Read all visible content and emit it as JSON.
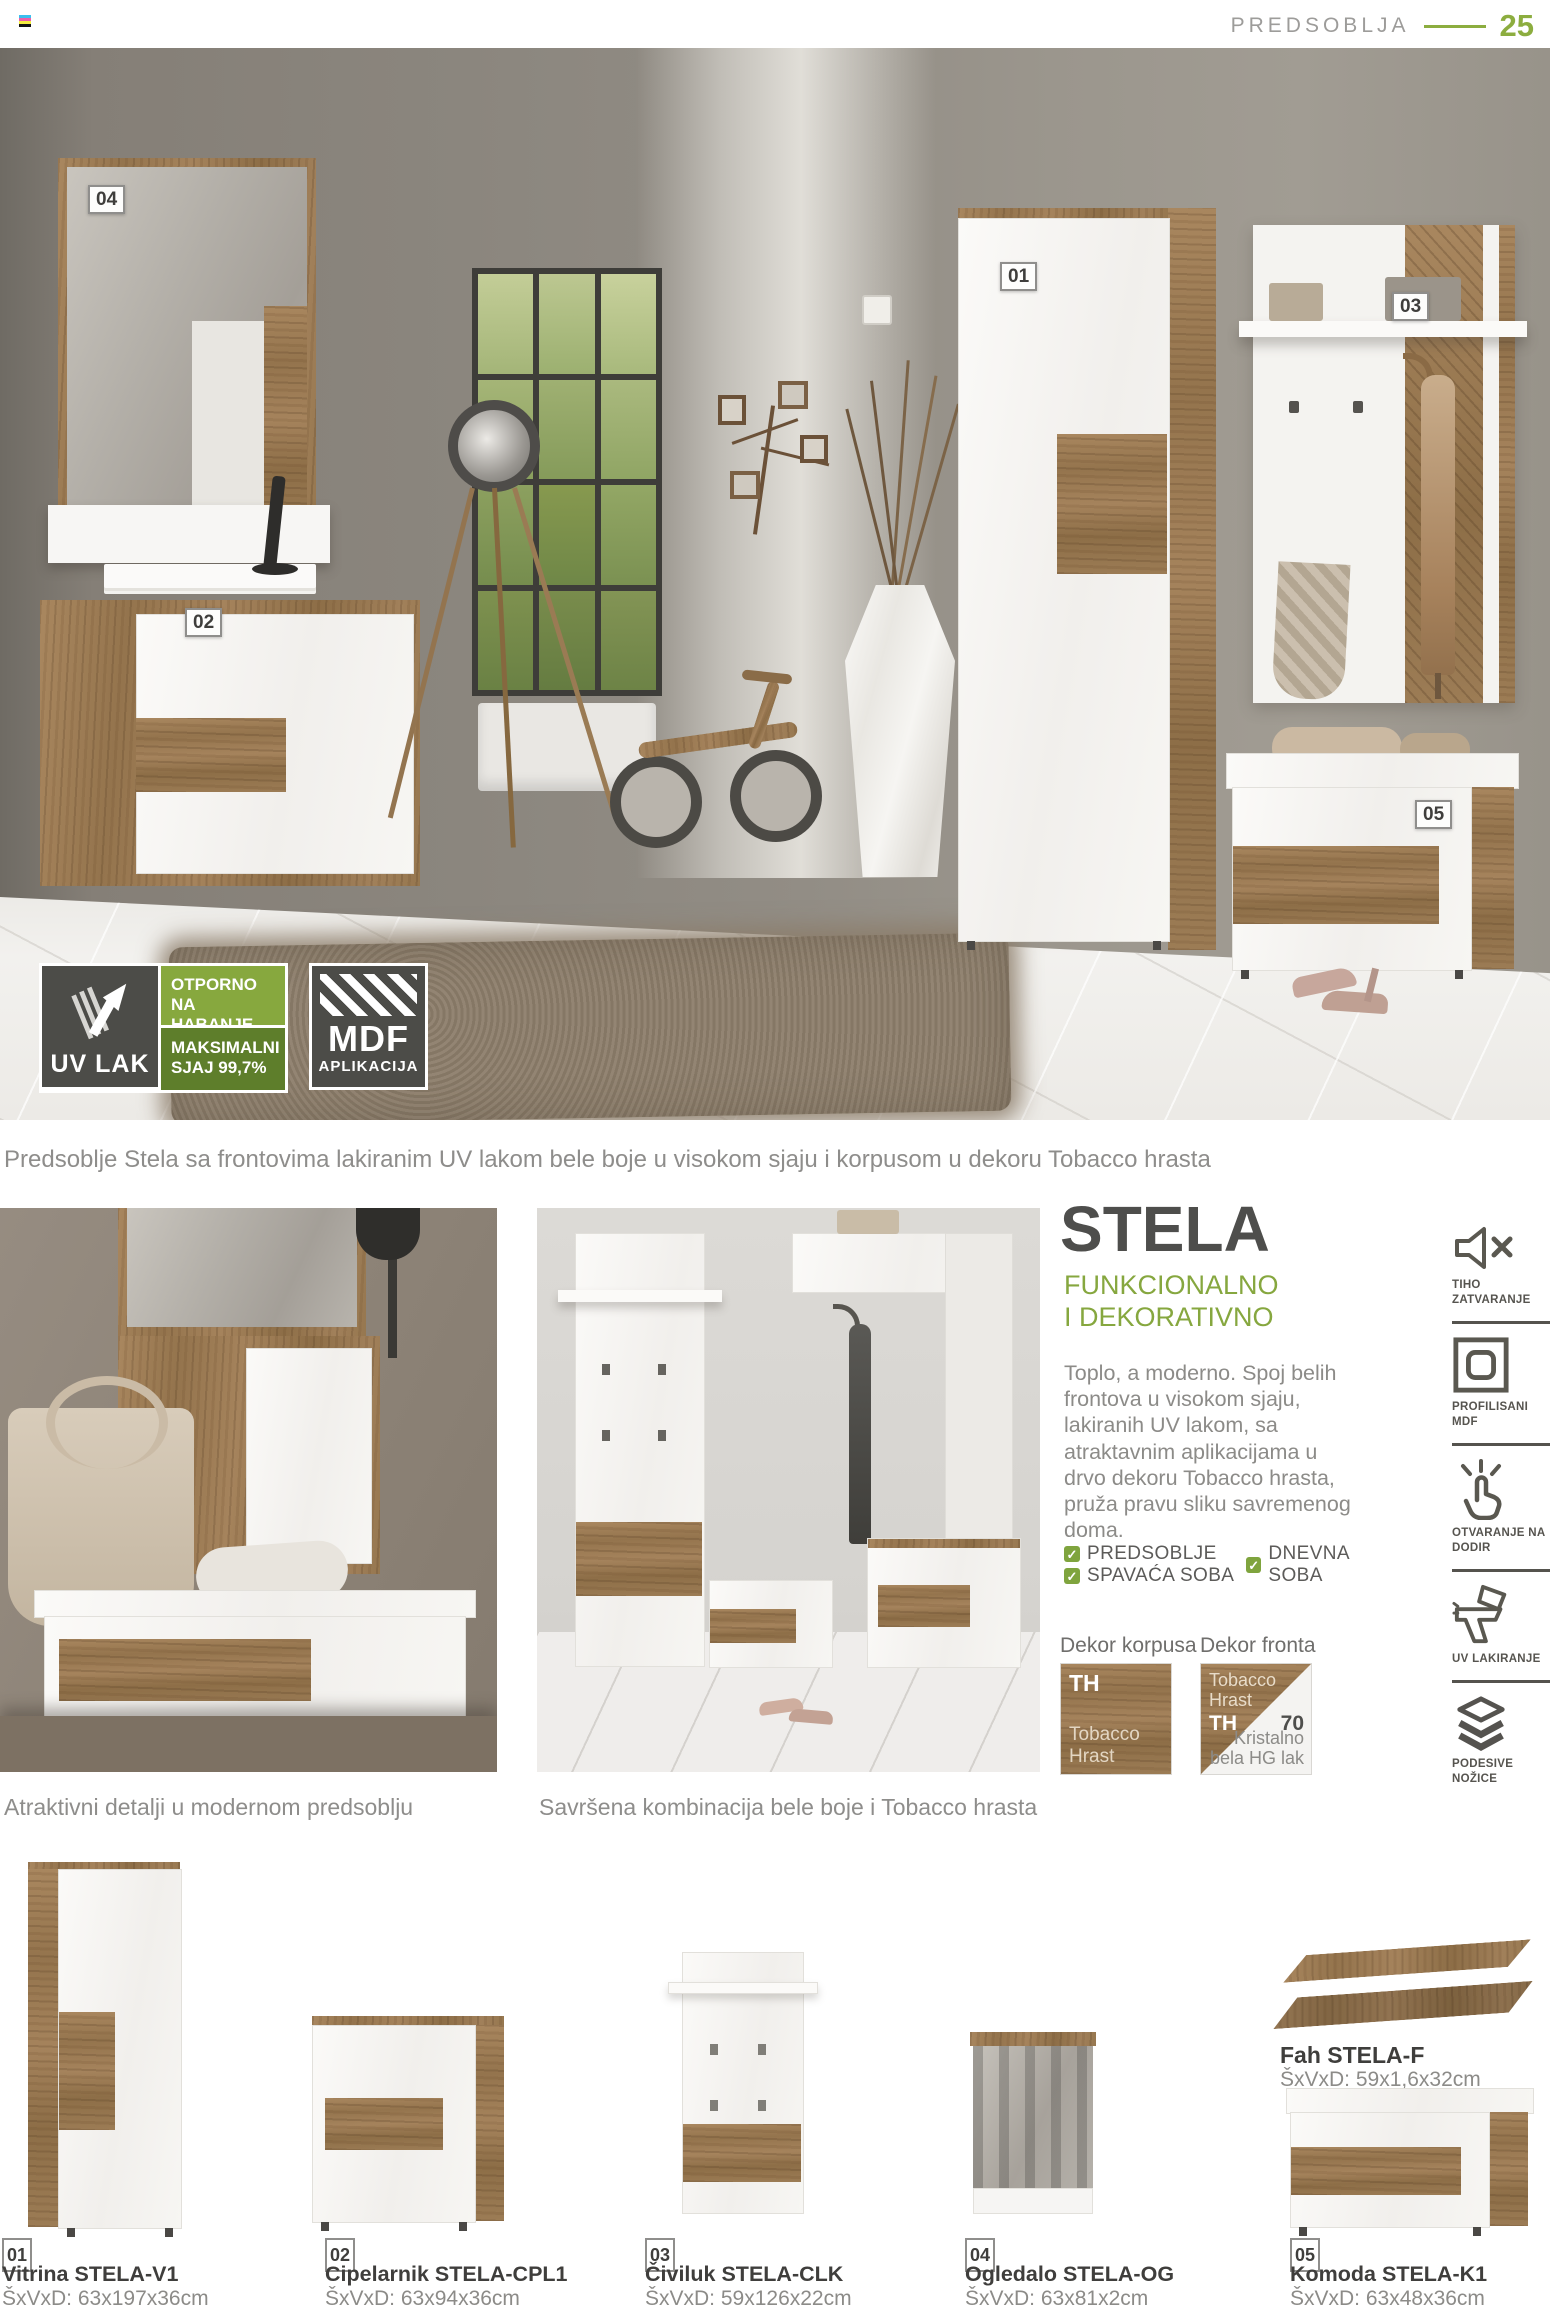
{
  "header": {
    "section": "PREDSOBLJA",
    "page": "25"
  },
  "hero": {
    "tags": [
      "01",
      "02",
      "03",
      "04",
      "05"
    ],
    "badges": {
      "uv_label": "UV LAK",
      "line1": "OTPORNO NA HABANJE",
      "line2": "MAKSIMALNI SJAJ 99,7%",
      "mdf": "MDF",
      "mdf_sub": "APLIKACIJA"
    },
    "caption": "Predsoblje Stela sa frontovima lakiranim UV lakom bele boje u visokom sjaju i korpusom u dekoru Tobacco hrasta"
  },
  "gallery": {
    "left_caption": "Atraktivni detalji u modernom predsoblju",
    "middle_caption": "Savršena kombinacija bele boje i Tobacco hrasta"
  },
  "stela": {
    "title": "STELA",
    "subtitle_line1": "FUNKCIONALNO",
    "subtitle_line2": "I DEKORATIVNO",
    "description": "Toplo, a moderno. Spoj belih frontova u visokom sjaju, lakiranih UV lakom, sa atraktavnim aplikacijama u drvo dekoru Tobacco hrasta, pruža pravu sliku savremenog doma.",
    "rooms": [
      "PREDSOBLJE",
      "SPAVAĆA SOBA",
      "DNEVNA SOBA"
    ]
  },
  "decor": {
    "korpus_heading": "Dekor korpusa",
    "front_heading": "Dekor fronta",
    "korpus_code": "TH",
    "korpus_name": "Tobacco Hrast",
    "front_wood_name_1": "Tobacco",
    "front_wood_name_2": "Hrast",
    "front_wood_code": "TH",
    "front_white_code": "70",
    "front_white_name_1": "Kristalno",
    "front_white_name_2": "bela HG lak"
  },
  "features": [
    {
      "icon": "speaker-mute-icon",
      "label": "TIHO ZATVARANJE"
    },
    {
      "icon": "profiled-mdf-icon",
      "label": "PROFILISANI MDF"
    },
    {
      "icon": "touch-open-icon",
      "label": "OTVARANJE NA DODIR"
    },
    {
      "icon": "spray-gun-icon",
      "label": "UV LAKIRANJE"
    },
    {
      "icon": "adjustable-feet-icon",
      "label": "PODESIVE NOŽICE"
    }
  ],
  "products": [
    {
      "tag": "01",
      "name": "Vitrina STELA-V1",
      "dims": "ŠxVxD: 63x197x36cm"
    },
    {
      "tag": "02",
      "name": "Cipelarnik STELA-CPL1",
      "dims": "ŠxVxD: 63x94x36cm"
    },
    {
      "tag": "03",
      "name": "Čiviluk STELA-CLK",
      "dims": "ŠxVxD: 59x126x22cm"
    },
    {
      "tag": "04",
      "name": "Ogledalo STELA-OG",
      "dims": "ŠxVxD: 63x81x2cm"
    },
    {
      "tag": "05",
      "name": "Komoda STELA-K1",
      "dims": "ŠxVxD: 63x48x36cm"
    }
  ],
  "fah": {
    "name": "Fah STELA-F",
    "dims": "ŠxVxD: 59x1,6x32cm"
  },
  "colors": {
    "accent_green": "#8cad3f",
    "badge_green_light": "#87a83e",
    "badge_green_dark": "#5e7e2b",
    "badge_dark": "#4c4c48",
    "wood": "#9d7c52",
    "text_dark": "#4e4e4c",
    "text_gray": "#8c8b88"
  }
}
